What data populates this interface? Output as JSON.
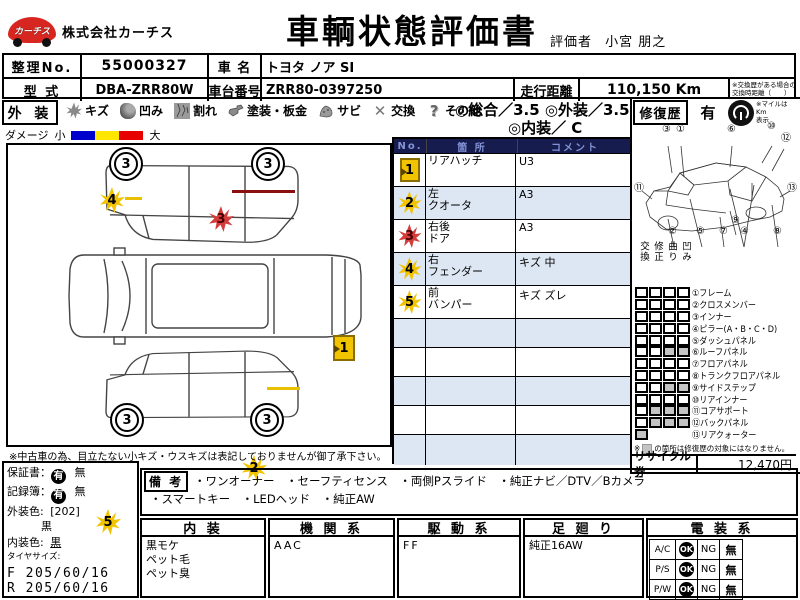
{
  "header": {
    "logo_text": "カーチス",
    "company": "株式会社カーチス",
    "title": "車輌状態評価書",
    "evaluator_label": "評価者",
    "evaluator_name": "小宮  朋之"
  },
  "info": {
    "no_label": "整理No.",
    "no": "55000327",
    "name_label": "車 名",
    "name": "トヨタ ノア SI",
    "model_label": "型 式",
    "model": "DBA-ZRR80W",
    "chassis_label": "車台番号",
    "chassis": "ZRR80-0397250",
    "mileage_label": "走行距離",
    "mileage": "110,150 Km",
    "mileage_note1": "※交換歴がある場合の",
    "mileage_note2": "交換時距離（　　）"
  },
  "legend": {
    "section": "外 装",
    "items": [
      {
        "label": "キズ"
      },
      {
        "label": "凹み"
      },
      {
        "label": "割れ"
      },
      {
        "label": "塗装・板金"
      },
      {
        "label": "サビ"
      },
      {
        "label": "交換"
      },
      {
        "label": "その他"
      }
    ],
    "rating_overall": "◎総合／3.5",
    "rating_exterior": "◎外装／3.5",
    "rating_interior": "◎内装／ C",
    "damage_label": "ダメージ",
    "damage_small": "小",
    "damage_large": "大"
  },
  "repair": {
    "label": "修復歴",
    "value": "有",
    "mile_note1": "※マイルは Km",
    "mile_note2": "表示"
  },
  "damage_table": {
    "header_no": "No.",
    "header_part": "箇 所",
    "header_comment": "コメント",
    "rows": [
      {
        "no": "1",
        "part1": "リアハッチ",
        "part2": "",
        "comment": "U3"
      },
      {
        "no": "2",
        "part1": "左",
        "part2": "クオータ",
        "comment": "A3"
      },
      {
        "no": "3",
        "part1": "右後",
        "part2": "ドア",
        "comment": "A3"
      },
      {
        "no": "4",
        "part1": "右",
        "part2": "フェンダー",
        "comment": "キズ 中"
      },
      {
        "no": "5",
        "part1": "前",
        "part2": "バンパー",
        "comment": "キズ ズレ"
      }
    ]
  },
  "diagram": {
    "tire_grade": "3",
    "markers": {
      "m1": "1",
      "m2": "2",
      "m3": "3",
      "m4": "4",
      "m5": "5"
    },
    "note": "※中古車の為、目立たない小キズ・ウスキズは表記しておりませんが御了承下さい。"
  },
  "parts": {
    "col1": "交換",
    "col2": "修正",
    "col3": "曲り",
    "col4": "凹み",
    "items": [
      {
        "label": "①フレーム",
        "cells": [
          "w",
          "w",
          "w",
          "w"
        ]
      },
      {
        "label": "②クロスメンバー",
        "cells": [
          "w",
          "w",
          "w",
          "w"
        ]
      },
      {
        "label": "③インナー",
        "cells": [
          "w",
          "w",
          "w",
          "w"
        ]
      },
      {
        "label": "④ピラー(A・B・C・D)",
        "cells": [
          "w",
          "w",
          "w",
          "w"
        ]
      },
      {
        "label": "⑤ダッシュパネル",
        "cells": [
          "w",
          "w",
          "w",
          "w"
        ]
      },
      {
        "label": "⑥ルーフパネル",
        "cells": [
          "w",
          "w",
          "g",
          "g"
        ]
      },
      {
        "label": "⑦フロアパネル",
        "cells": [
          "w",
          "w",
          "w",
          "w"
        ]
      },
      {
        "label": "⑧トランクフロアパネル",
        "cells": [
          "w",
          "w",
          "w",
          "w"
        ]
      },
      {
        "label": "⑨サイドステップ",
        "cells": [
          "w",
          "w",
          "g",
          "g"
        ]
      },
      {
        "label": "⑩リアインナー",
        "cells": [
          "w",
          "w",
          "w",
          "w"
        ]
      },
      {
        "label": "⑪コアサポート",
        "cells": [
          "w",
          "g",
          "g",
          "g"
        ]
      },
      {
        "label": "⑫バックパネル",
        "cells": [
          "w",
          "g",
          "g",
          "g"
        ]
      },
      {
        "label": "⑬リアクォーター",
        "cells": [
          "g"
        ]
      }
    ],
    "note_prefix": "※",
    "note": "の箇所は修復歴の対象にはなりません。"
  },
  "recycle": {
    "label": "リサイクル券",
    "value": "12,470円"
  },
  "skeleton": {
    "callouts": [
      "③",
      "①",
      "⑥",
      "⑩",
      "⑫",
      "⑪",
      "②",
      "⑤",
      "⑦",
      "⑨",
      "④",
      "⑧",
      "⑬"
    ]
  },
  "left_info": {
    "warranty_label": "保証書：",
    "record_label": "記録簿：",
    "yes": "有",
    "no": "無",
    "ext_label": "外装色:",
    "ext_code": "[202]",
    "ext_color": "黒",
    "int_label": "内装色:",
    "int_color": "黒",
    "tire_label": "タイヤサイズ:",
    "tire_f": "F 205/60/16",
    "tire_r": "R 205/60/16"
  },
  "remarks": {
    "label": "備 考",
    "line1": "・ワンオーナー　・セーフティセンス　・両側Pスライド　・純正ナビ／DTV／Bカメラ",
    "line2": "・スマートキー　・LEDヘッド　・純正AW"
  },
  "bottom": {
    "interior_header": "内 装",
    "interior1": "黒モケ",
    "interior2": "ペット毛",
    "interior3": "ペット臭",
    "engine_header": "機 関 系",
    "engine": "AAC",
    "drive_header": "駆 動 系",
    "drive": "FF",
    "suspension_header": "足 廻 り",
    "suspension": "純正16AW",
    "electrical_header": "電 装 系",
    "elec_rows": [
      {
        "label": "A/C",
        "ok": "OK",
        "ng": "NG",
        "none": "無"
      },
      {
        "label": "P/S",
        "ok": "OK",
        "ng": "NG",
        "none": "無"
      },
      {
        "label": "P/W",
        "ok": "OK",
        "ng": "NG",
        "none": "無"
      }
    ]
  }
}
